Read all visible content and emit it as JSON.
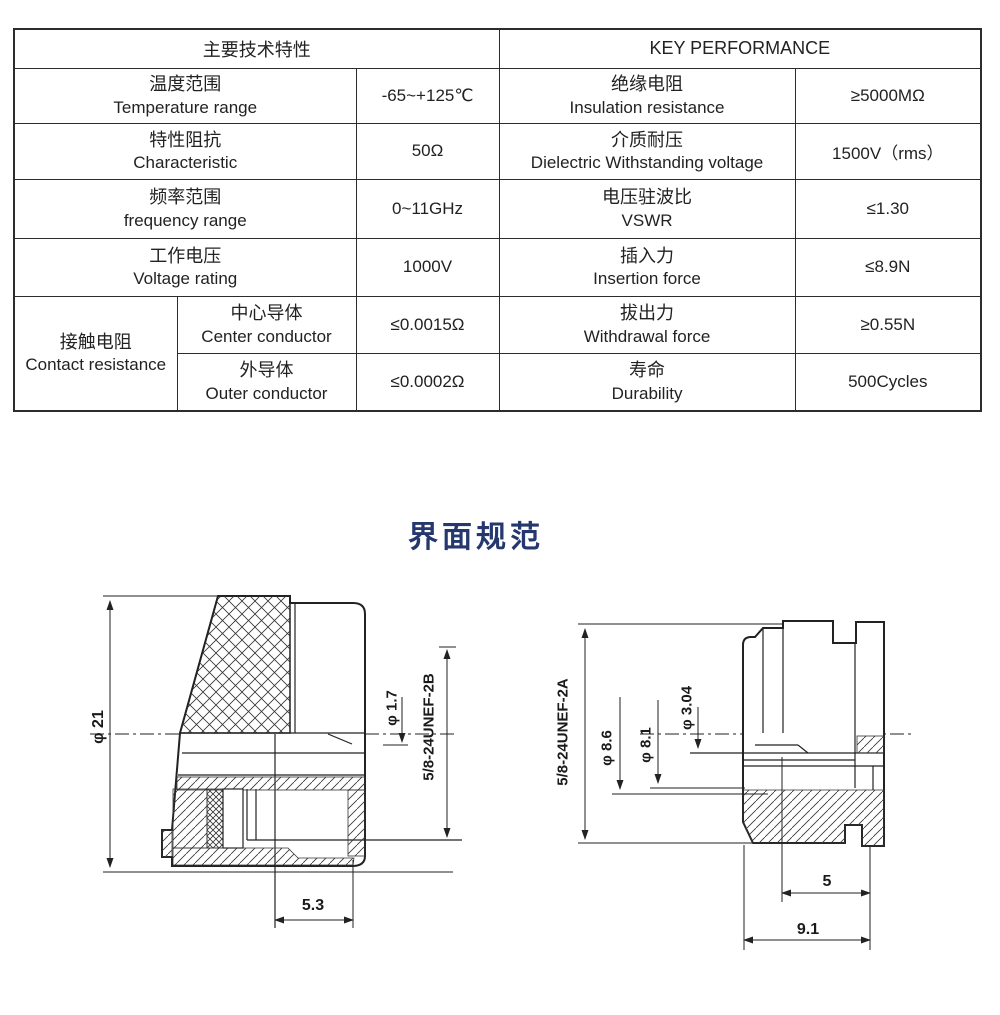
{
  "header": {
    "left": "主要技术特性",
    "right": "KEY PERFORMANCE"
  },
  "rows": [
    {
      "zh": "温度范围",
      "en": "Temperature range",
      "val": "-65~+125℃",
      "rzh": "绝缘电阻",
      "ren": "Insulation resistance",
      "rval": "≥5000MΩ"
    },
    {
      "zh": "特性阻抗",
      "en": "Characteristic",
      "val": "50Ω",
      "rzh": "介质耐压",
      "ren": "Dielectric Withstanding voltage",
      "rval": "1500V（rms）"
    },
    {
      "zh": "频率范围",
      "en": "frequency range",
      "val": "0~11GHz",
      "rzh": "电压驻波比",
      "ren": "VSWR",
      "rval": "≤1.30"
    },
    {
      "zh": "工作电压",
      "en": "Voltage rating",
      "val": "1000V",
      "rzh": "插入力",
      "ren": "Insertion force",
      "rval": "≤8.9N"
    }
  ],
  "contact": {
    "zh": "接触电阻",
    "en": "Contact resistance",
    "sub": [
      {
        "zh": "中心导体",
        "en": "Center conductor",
        "val": "≤0.0015Ω",
        "rzh": "拔出力",
        "ren": "Withdrawal force",
        "rval": "≥0.55N"
      },
      {
        "zh": "外导体",
        "en": "Outer conductor",
        "val": "≤0.0002Ω",
        "rzh": "寿命",
        "ren": "Durability",
        "rval": "500Cycles"
      }
    ]
  },
  "section_title": "界面规范",
  "left_drawing": {
    "body_dia": "φ 21",
    "pin_dia": "φ 1.7",
    "thread": "5/8-24UNEF-2B",
    "depth": "5.3"
  },
  "right_drawing": {
    "thread": "5/8-24UNEF-2A",
    "dia_86": "φ 8.6",
    "dia_81": "φ 8.1",
    "dia_304": "φ 3.04",
    "len_5": "5",
    "len_91": "9.1"
  }
}
